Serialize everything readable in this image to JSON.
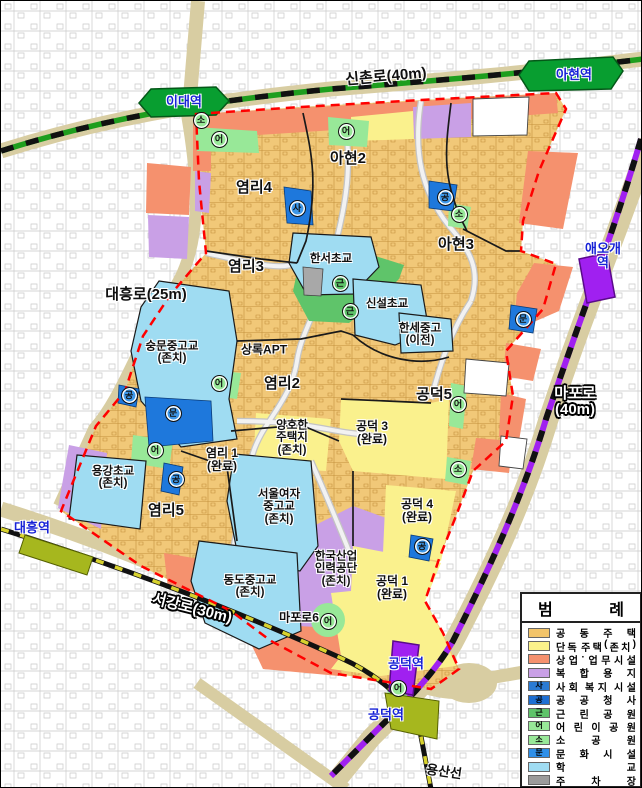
{
  "legend": {
    "title_display": [
      "범",
      "례"
    ],
    "items": [
      {
        "label": "공동주택",
        "color": "#F2C46A",
        "letter": ""
      },
      {
        "label": "단독 주택(존치)",
        "color": "#FBF28B",
        "letter": ""
      },
      {
        "label": "상업·업무시설",
        "color": "#F5916E",
        "letter": ""
      },
      {
        "label": "복합용지",
        "color": "#C9A0E6",
        "letter": ""
      },
      {
        "label": "사회 복지 시설",
        "color": "#2B7BD4",
        "letter": "사"
      },
      {
        "label": "공공청사",
        "color": "#1E6FD2",
        "letter": "공"
      },
      {
        "label": "근린공원",
        "color": "#5FC46A",
        "letter": "근"
      },
      {
        "label": "어린이공원",
        "color": "#98E898",
        "letter": "어"
      },
      {
        "label": "소공원",
        "color": "#98E898",
        "letter": "소"
      },
      {
        "label": "문화시설",
        "color": "#2E8FE8",
        "letter": "문"
      },
      {
        "label": "학교",
        "color": "#9FDCF2",
        "letter": ""
      },
      {
        "label": "주차장",
        "color": "#9B9B9B",
        "letter": ""
      }
    ]
  },
  "map": {
    "badge_colors": {
      "어": "#98E898",
      "소": "#98E898",
      "근": "#5FC46A",
      "사": "#3E97E8",
      "공": "#3E97E8",
      "문": "#3E97E8"
    },
    "labels": [
      {
        "name": "zone-label-yeomni4",
        "cls": "zone",
        "x": 253,
        "y": 187,
        "text": "염리4"
      },
      {
        "name": "zone-label-ahyeon2",
        "cls": "zone",
        "x": 347,
        "y": 158,
        "text": "아현2"
      },
      {
        "name": "zone-label-ahyeon3",
        "cls": "zone",
        "x": 455,
        "y": 244,
        "text": "아현3"
      },
      {
        "name": "zone-label-yeomni3",
        "cls": "zone",
        "x": 245,
        "y": 266,
        "text": "염리3"
      },
      {
        "name": "zone-label-yeomni2",
        "cls": "zone",
        "x": 281,
        "y": 383,
        "text": "염리2"
      },
      {
        "name": "zone-label-yeomni5",
        "cls": "zone",
        "x": 165,
        "y": 510,
        "text": "염리5"
      },
      {
        "name": "zone-label-gongdeok5",
        "cls": "zone",
        "x": 433,
        "y": 394,
        "text": "공덕5"
      },
      {
        "name": "zone-label-yeomni1",
        "cls": "zone-sm",
        "x": 221,
        "y": 459,
        "text": "염리 1\n(완료)"
      },
      {
        "name": "zone-label-gongdeok3",
        "cls": "zone-sm",
        "x": 371,
        "y": 432,
        "text": "공덕 3\n(완료)"
      },
      {
        "name": "zone-label-gongdeok4",
        "cls": "zone-sm",
        "x": 416,
        "y": 510,
        "text": "공덕 4\n(완료)"
      },
      {
        "name": "zone-label-gongdeok1",
        "cls": "zone-sm",
        "x": 391,
        "y": 587,
        "text": "공덕 1\n(완료)"
      },
      {
        "name": "zone-label-maporo6",
        "cls": "zone-sm",
        "x": 298,
        "y": 617,
        "text": "마포로6"
      },
      {
        "name": "zone-label-sangnok-apt",
        "cls": "zone-sm",
        "x": 263,
        "y": 349,
        "text": "상록APT"
      },
      {
        "name": "facility-label-hanseo-elem",
        "cls": "facility",
        "x": 330,
        "y": 258,
        "text": "한서초교"
      },
      {
        "name": "facility-label-sinseol-elem",
        "cls": "facility",
        "x": 386,
        "y": 303,
        "text": "신설초교"
      },
      {
        "name": "facility-label-hanse-school",
        "cls": "facility",
        "x": 419,
        "y": 334,
        "text": "한세중고\n(이전)"
      },
      {
        "name": "facility-label-sungmun-school",
        "cls": "facility",
        "x": 171,
        "y": 352,
        "text": "숭문중고교\n(존치)"
      },
      {
        "name": "facility-label-yonggang-elem",
        "cls": "facility",
        "x": 112,
        "y": 477,
        "text": "용강초교\n(존치)"
      },
      {
        "name": "facility-label-seoul-womens",
        "cls": "facility",
        "x": 278,
        "y": 506,
        "text": "서울여자\n중고교\n(존치)"
      },
      {
        "name": "facility-label-dongdo-school",
        "cls": "facility",
        "x": 249,
        "y": 586,
        "text": "동도중고교\n(존치)"
      },
      {
        "name": "facility-label-hrd-korea",
        "cls": "facility",
        "x": 335,
        "y": 568,
        "text": "한국산업\n인력공단\n(존치)"
      },
      {
        "name": "facility-label-yangho-housing",
        "cls": "facility",
        "x": 291,
        "y": 437,
        "text": "양호한\n주택지\n(존치)"
      },
      {
        "name": "station-label-idae",
        "cls": "station",
        "x": 183,
        "y": 101,
        "text": "이대역"
      },
      {
        "name": "station-label-ahyeon",
        "cls": "station",
        "x": 573,
        "y": 74,
        "text": "아현역"
      },
      {
        "name": "station-label-aeogae",
        "cls": "station",
        "x": 602,
        "y": 255,
        "text": "애오개역"
      },
      {
        "name": "station-label-daeheung",
        "cls": "station",
        "x": 31,
        "y": 527,
        "text": "대흥역"
      },
      {
        "name": "station-label-gongdeok-1",
        "cls": "station",
        "x": 405,
        "y": 663,
        "text": "공덕역"
      },
      {
        "name": "station-label-gongdeok-2",
        "cls": "station",
        "x": 385,
        "y": 714,
        "text": "공덕역"
      },
      {
        "name": "road-label-sinchon-ro",
        "cls": "road-dark",
        "x": 385,
        "y": 76,
        "rot": -5,
        "text": "신촌로(40m)"
      },
      {
        "name": "road-label-daeheung-ro",
        "cls": "road-dark",
        "x": 145,
        "y": 294,
        "text": "대흥로(25m)"
      },
      {
        "name": "road-label-mapo-ro",
        "cls": "road-light",
        "x": 574,
        "y": 401,
        "text": "마포로(40m)"
      },
      {
        "name": "road-label-seogang-ro",
        "cls": "road-light",
        "x": 191,
        "y": 608,
        "rot": 14,
        "text": "서강로(30m)"
      },
      {
        "name": "rail-label-yongsan-line",
        "cls": "rail",
        "x": 443,
        "y": 771,
        "rot": 8,
        "text": "용산선"
      }
    ],
    "badges": [
      {
        "letter": "소",
        "x": 200,
        "y": 119
      },
      {
        "letter": "어",
        "x": 218,
        "y": 138
      },
      {
        "letter": "어",
        "x": 345,
        "y": 130
      },
      {
        "letter": "사",
        "x": 296,
        "y": 207
      },
      {
        "letter": "공",
        "x": 444,
        "y": 196
      },
      {
        "letter": "소",
        "x": 458,
        "y": 213
      },
      {
        "letter": "근",
        "x": 339,
        "y": 282
      },
      {
        "letter": "근",
        "x": 349,
        "y": 310
      },
      {
        "letter": "문",
        "x": 522,
        "y": 318
      },
      {
        "letter": "어",
        "x": 218,
        "y": 382
      },
      {
        "letter": "문",
        "x": 172,
        "y": 412
      },
      {
        "letter": "공",
        "x": 128,
        "y": 394
      },
      {
        "letter": "어",
        "x": 154,
        "y": 449
      },
      {
        "letter": "공",
        "x": 175,
        "y": 478
      },
      {
        "letter": "어",
        "x": 457,
        "y": 403
      },
      {
        "letter": "소",
        "x": 457,
        "y": 468
      },
      {
        "letter": "공",
        "x": 421,
        "y": 545
      },
      {
        "letter": "어",
        "x": 327,
        "y": 620
      },
      {
        "letter": "어",
        "x": 397,
        "y": 687
      }
    ]
  }
}
